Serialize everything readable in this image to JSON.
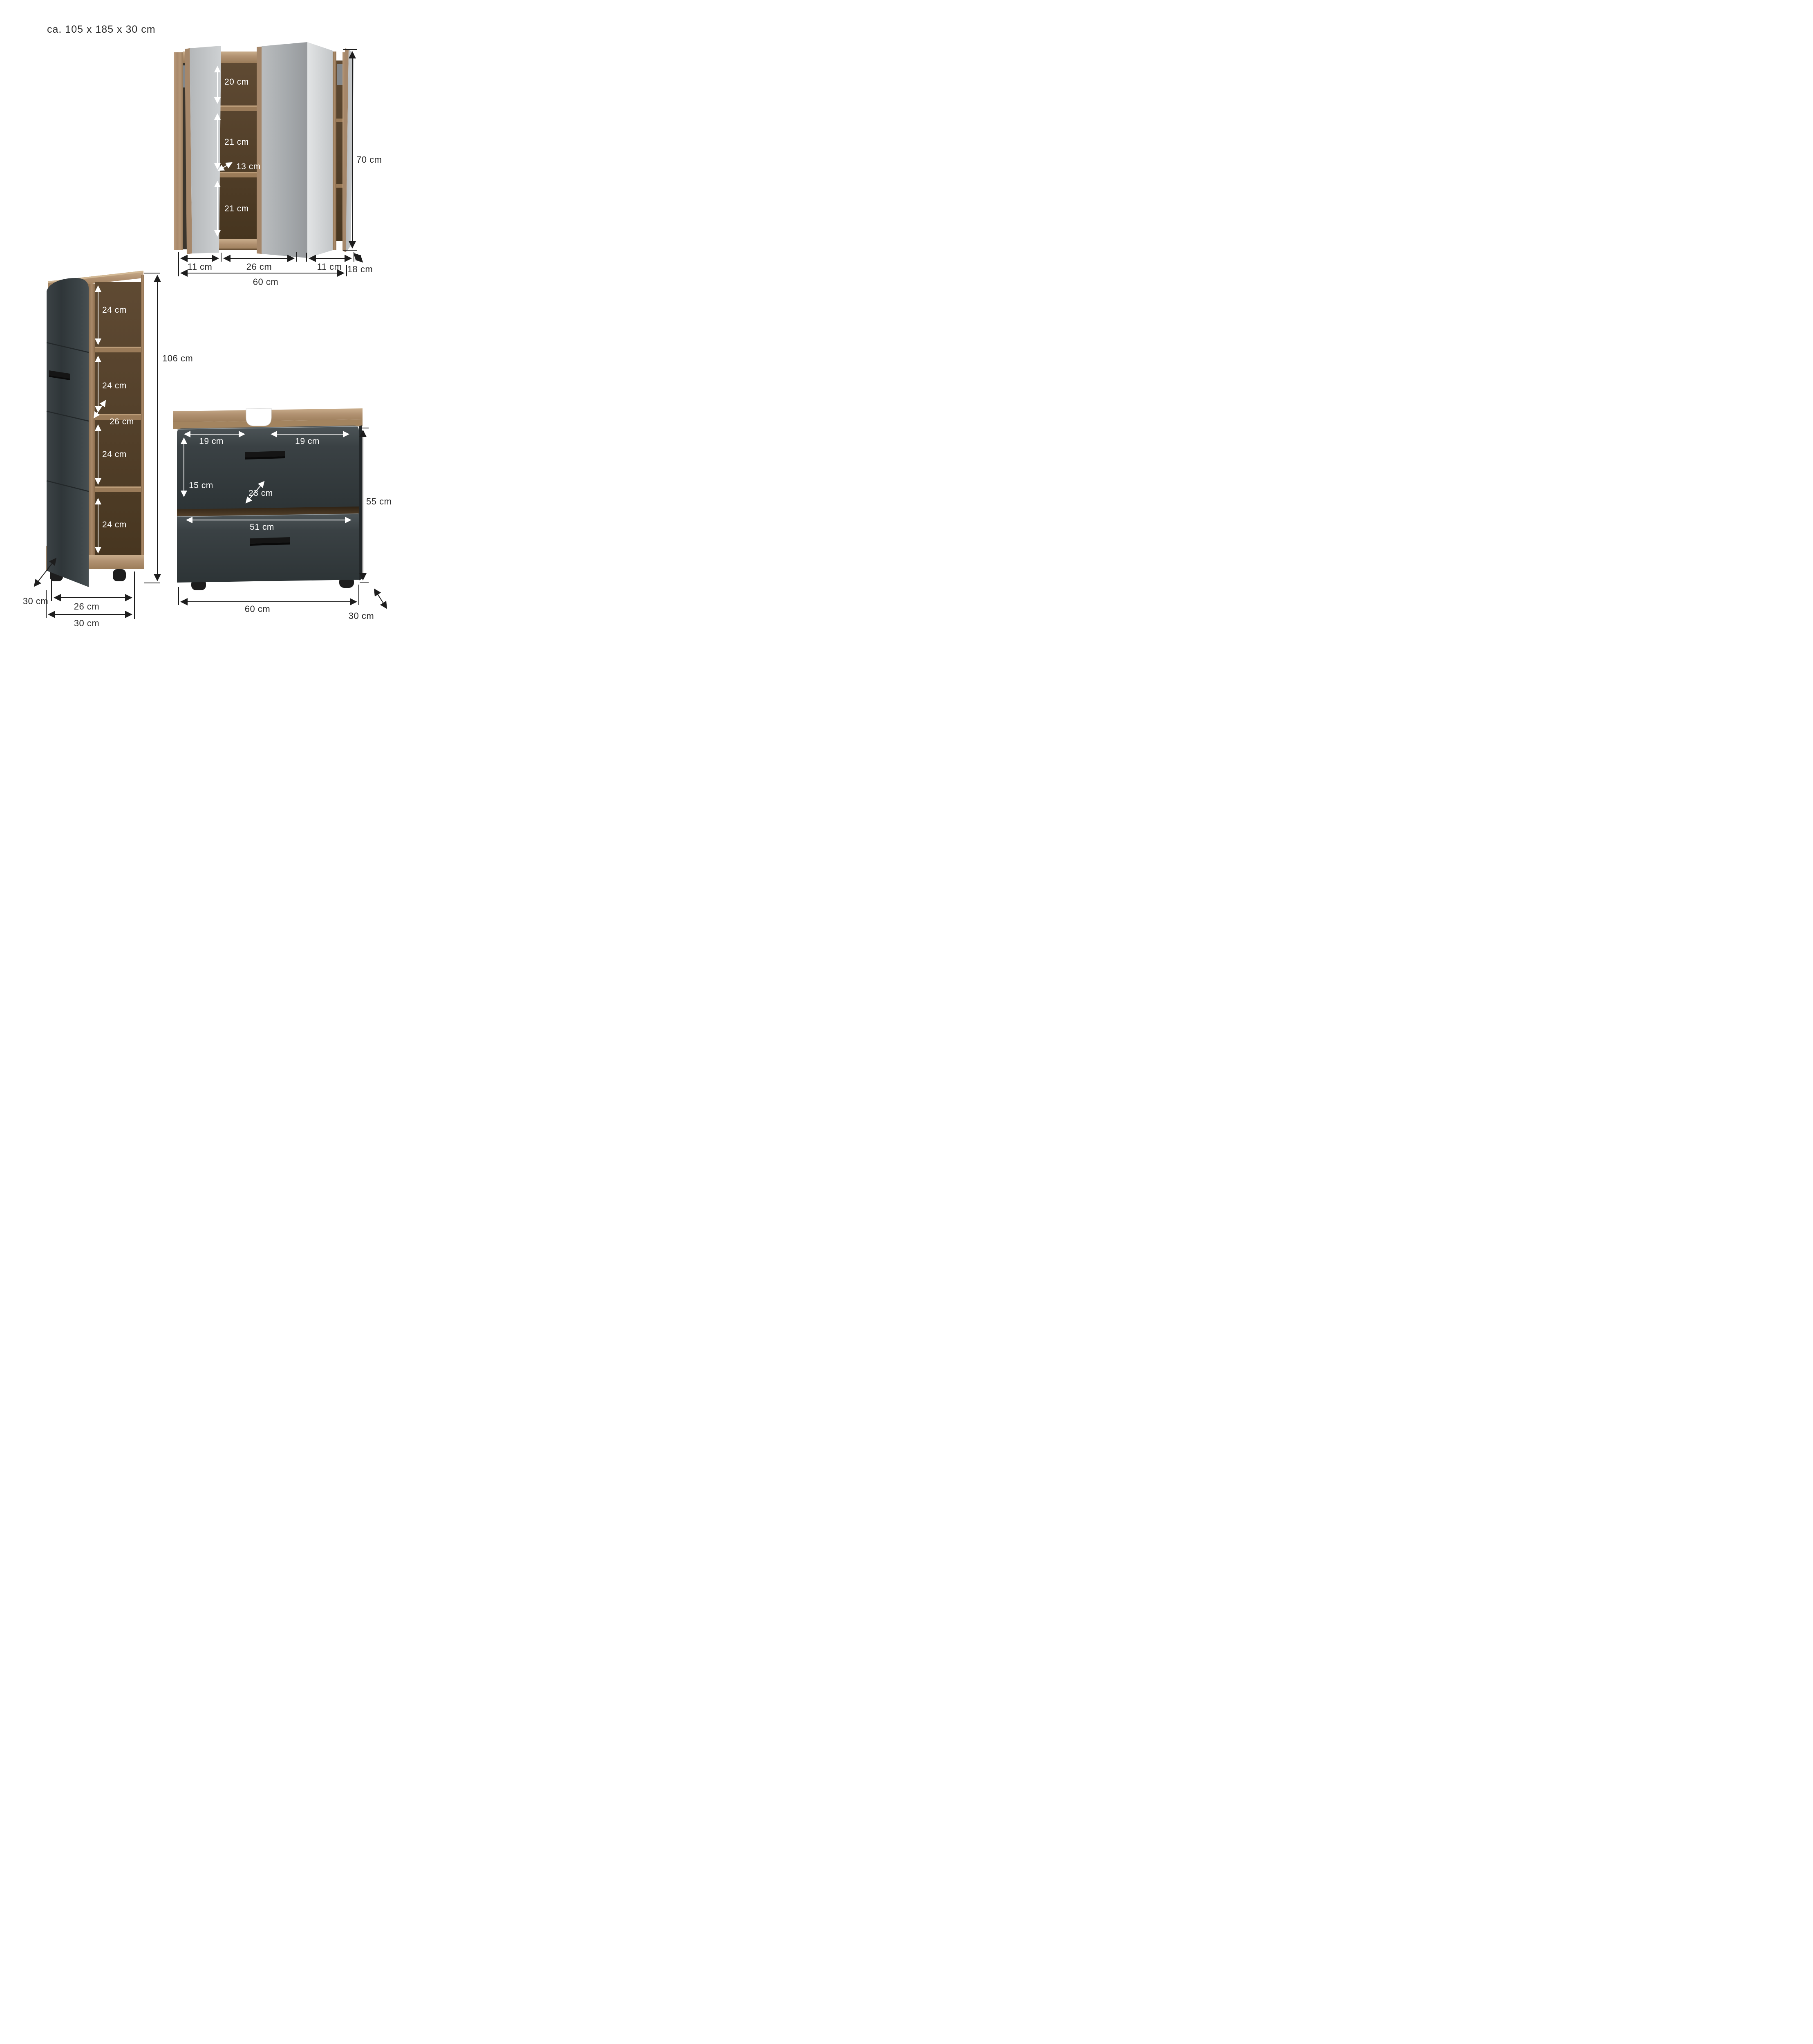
{
  "title": "ca. 105 x 185 x 30 cm",
  "colors": {
    "wood_light": "#b3946f",
    "wood_top": "#c4a480",
    "wood_dark_interior": "#54402b",
    "anthracite": "#3a4144",
    "mirror": "#c0c3c5",
    "dim_line_black": "#1d1d1d",
    "dim_line_white": "#ffffff",
    "handle_black": "#151515"
  },
  "mirror_cabinet": {
    "shelf_heights": [
      "20 cm",
      "21 cm",
      "21 cm"
    ],
    "shelf_depth": "13 cm",
    "height": "70 cm",
    "section_widths": [
      "11 cm",
      "26 cm",
      "11 cm"
    ],
    "depth": "18 cm",
    "width": "60 cm"
  },
  "tall_cabinet": {
    "shelf_heights": [
      "24 cm",
      "24 cm",
      "24 cm",
      "24 cm"
    ],
    "shelf_depth": "26 cm",
    "height": "106 cm",
    "depth": "30 cm",
    "inner_width": "26 cm",
    "width": "30 cm"
  },
  "vanity": {
    "top_left_width": "19 cm",
    "top_right_width": "19 cm",
    "drawer_height": "15 cm",
    "drawer_depth": "23 cm",
    "lower_inner_width": "51 cm",
    "height": "55 cm",
    "width": "60 cm",
    "depth": "30 cm"
  }
}
